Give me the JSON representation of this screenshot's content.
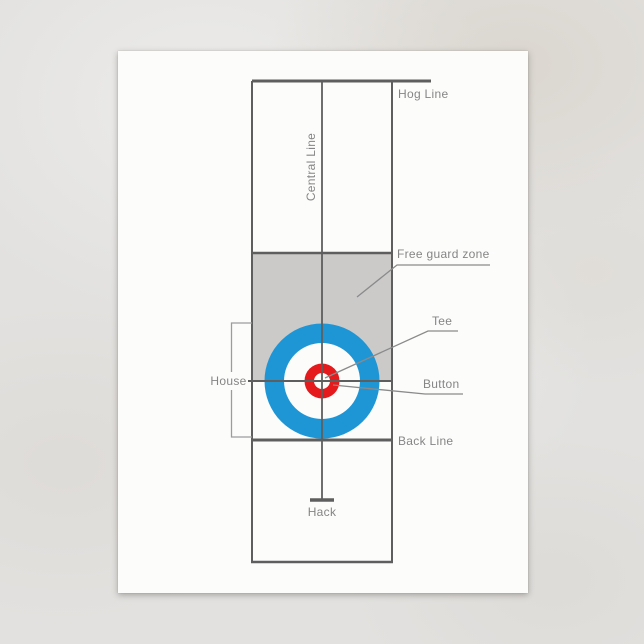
{
  "scene": {
    "background_color": "#e2e1df",
    "postcard_color": "#fcfcfb"
  },
  "diagram": {
    "labels": {
      "hog_line": "Hog Line",
      "central_line": "Central Line",
      "free_guard_zone": "Free guard zone",
      "tee": "Tee",
      "house": "House",
      "button": "Button",
      "back_line": "Back Line",
      "hack": "Hack"
    },
    "colors": {
      "rink_line": "#5e5e5e",
      "leader_line": "#8a8a8a",
      "bracket_line": "#9c9c9c",
      "label_text": "#858585",
      "free_guard_zone_fill": "#cbcac9",
      "house_outer_ring_blue": "#1e96d6",
      "house_button_red": "#e41a1c",
      "house_white": "#fcfcfb"
    }
  }
}
